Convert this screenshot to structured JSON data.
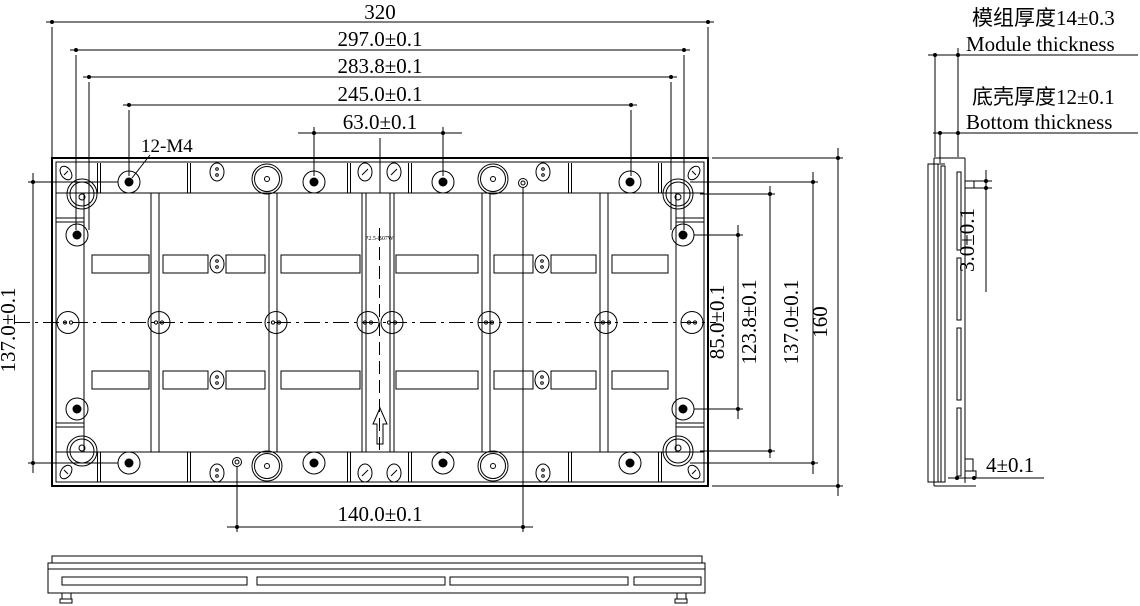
{
  "top_view": {
    "overall_width": "320",
    "bolt_span_width": "297.0±0.1",
    "inner_span_width": "283.8±0.1",
    "hole_span_width": "245.0±0.1",
    "center_hole_spacing": "63.0±0.1",
    "bottom_hole_spacing": "140.0±0.1",
    "thread_label": "12-M4",
    "module_model": "P2.5-B07W",
    "left_height": "137.0±0.1"
  },
  "right_dims": {
    "side_hole_spacing": "85.0±0.1",
    "corner_spacing": "123.8±0.1",
    "bolt_span_height": "137.0±0.1",
    "overall_height": "160"
  },
  "side_view": {
    "module_thickness_cn": "模组厚度14±0.3",
    "module_thickness_en": "Module thickness",
    "bottom_thickness_cn": "底壳厚度12±0.1",
    "bottom_thickness_en": "Bottom thickness",
    "tab_thickness": "3.0±0.1",
    "foot_width": "4±0.1"
  },
  "colors": {
    "line": "#000000",
    "background": "#ffffff"
  }
}
